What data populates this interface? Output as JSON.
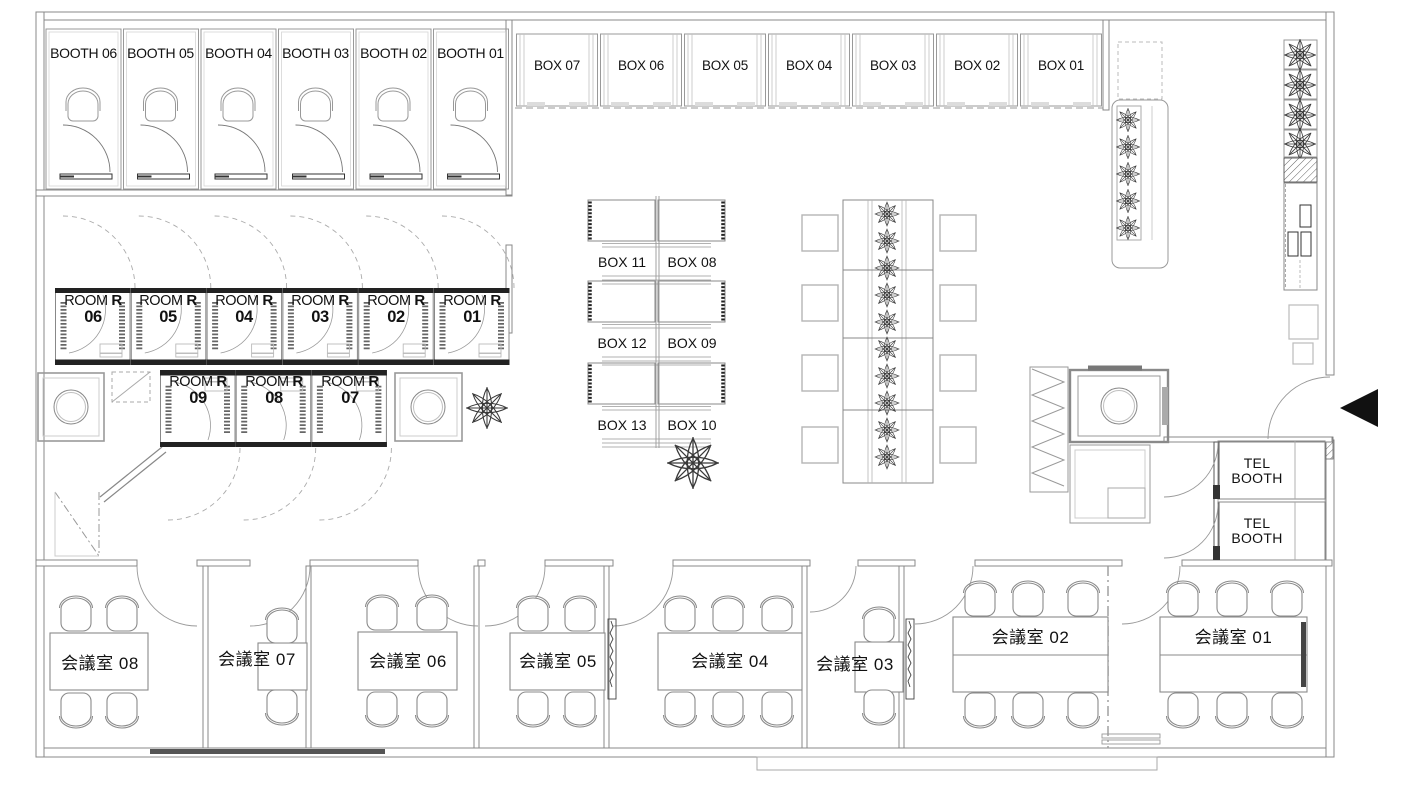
{
  "plan": {
    "title": "office-floor-plan",
    "colors": {
      "line": "#8a8a8a",
      "dark": "#222222",
      "text": "#111111",
      "background": "#ffffff"
    },
    "booths": [
      {
        "label": "BOOTH 06"
      },
      {
        "label": "BOOTH 05"
      },
      {
        "label": "BOOTH 04"
      },
      {
        "label": "BOOTH 03"
      },
      {
        "label": "BOOTH 02"
      },
      {
        "label": "BOOTH 01"
      }
    ],
    "top_boxes": [
      {
        "label": "BOX 07"
      },
      {
        "label": "BOX 06"
      },
      {
        "label": "BOX 05"
      },
      {
        "label": "BOX 04"
      },
      {
        "label": "BOX 03"
      },
      {
        "label": "BOX 02"
      },
      {
        "label": "BOX 01"
      }
    ],
    "rooms_upper": [
      {
        "word": "ROOM",
        "letter": "R",
        "number": "06"
      },
      {
        "word": "ROOM",
        "letter": "R",
        "number": "05"
      },
      {
        "word": "ROOM",
        "letter": "R",
        "number": "04"
      },
      {
        "word": "ROOM",
        "letter": "R",
        "number": "03"
      },
      {
        "word": "ROOM",
        "letter": "R",
        "number": "02"
      },
      {
        "word": "ROOM",
        "letter": "R",
        "number": "01"
      }
    ],
    "rooms_lower": [
      {
        "word": "ROOM",
        "letter": "R",
        "number": "09"
      },
      {
        "word": "ROOM",
        "letter": "R",
        "number": "08"
      },
      {
        "word": "ROOM",
        "letter": "R",
        "number": "07"
      }
    ],
    "center_box_pairs": [
      {
        "left": "BOX 11",
        "right": "BOX 08"
      },
      {
        "left": "BOX 12",
        "right": "BOX 09"
      },
      {
        "left": "BOX 13",
        "right": "BOX 10"
      }
    ],
    "tel_booths": [
      {
        "line1": "TEL",
        "line2": "BOOTH"
      },
      {
        "line1": "TEL",
        "line2": "BOOTH"
      }
    ],
    "meeting_rooms": [
      {
        "label": "会議室 08"
      },
      {
        "label": "会議室 07"
      },
      {
        "label": "会議室 06"
      },
      {
        "label": "会議室 05"
      },
      {
        "label": "会議室 04"
      },
      {
        "label": "会議室 03"
      },
      {
        "label": "会議室 02"
      },
      {
        "label": "会議室 01"
      }
    ]
  }
}
